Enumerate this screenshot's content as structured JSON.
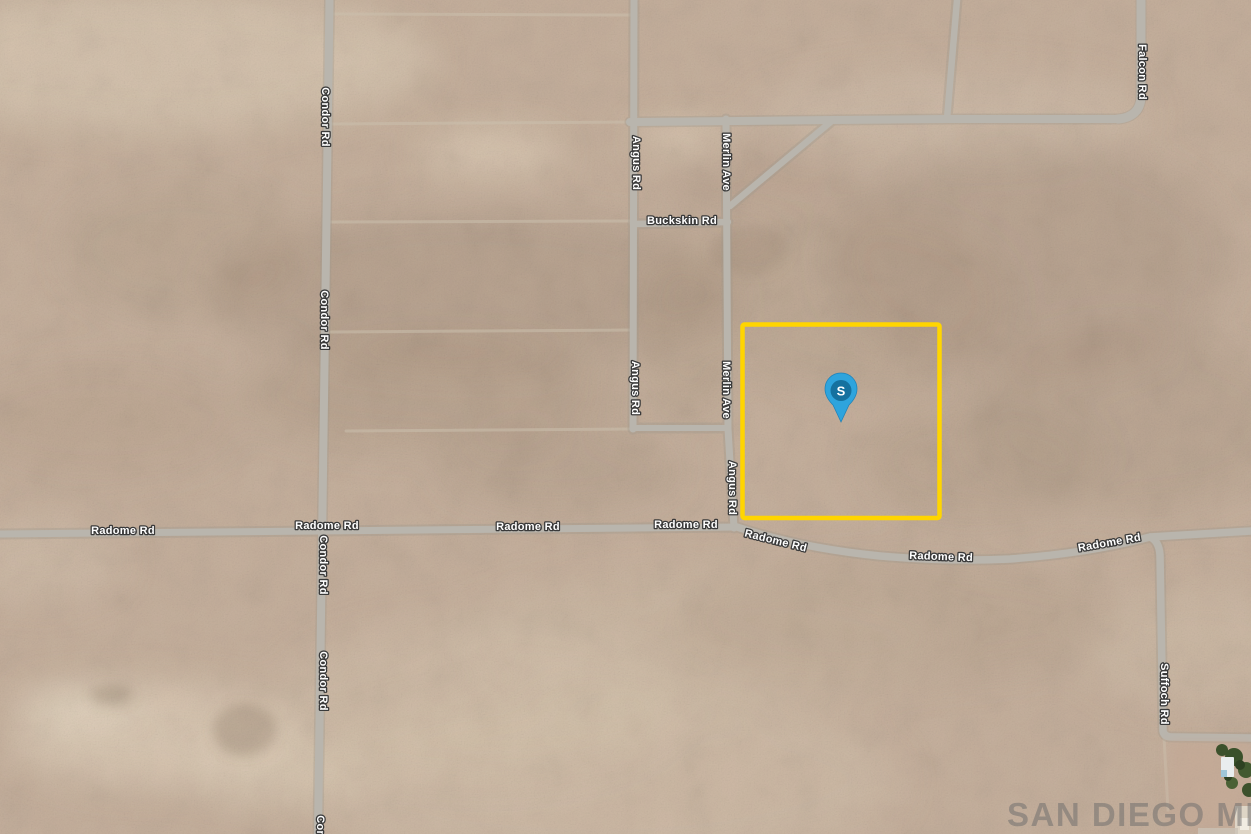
{
  "map": {
    "labels": {
      "condor": "Condor Rd",
      "angus": "Angus Rd",
      "merlin": "Merlin Ave",
      "buckskin": "Buckskin Rd",
      "falcon": "Falcon Rd",
      "radome": "Radome Rd",
      "suffoch": "Suffoch Rd"
    },
    "marker": {
      "label": "S",
      "balloon_color": "#2EA4DD",
      "badge_color": "#15719F"
    },
    "parcel": {
      "outline_color": "#FFD500"
    },
    "watermark": {
      "text": "SAN DIEGO MLS",
      "color": "#6B6B6B"
    }
  }
}
